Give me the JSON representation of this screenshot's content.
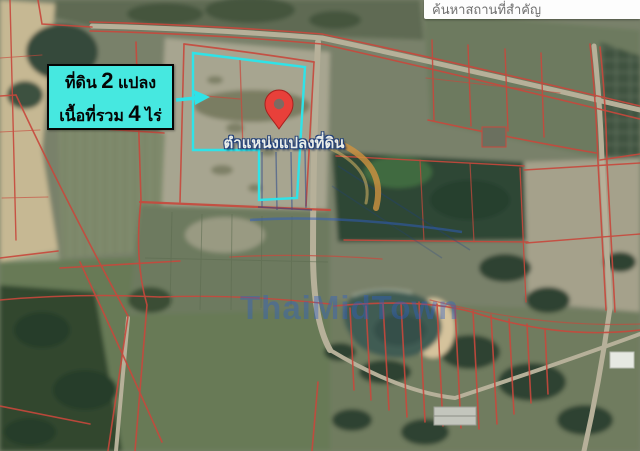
{
  "search_bar": {
    "placeholder": "ค้นหาสถานที่สำคัญ"
  },
  "callout": {
    "line1": {
      "prefix": "ที่ดิน",
      "number": "2",
      "suffix": "แปลง"
    },
    "line2": {
      "prefix": "เนื้อที่รวม",
      "number": "4",
      "suffix": "ไร่"
    }
  },
  "map": {
    "pin_caption": "ตำแหน่งแปลงที่ดิน",
    "watermark": "ThaiMidTown",
    "plots_outlined": 2,
    "area_rai": 4
  },
  "colors": {
    "callout_bg": "#46e8e0",
    "callout_border": "#050505",
    "plot_outline": "#2fe3e8",
    "arrow": "#2fe3e8",
    "pin_red": "#e8403a",
    "pin_inner": "#7d6a62",
    "parcel_line": "#c8483c",
    "survey_line": "#1d3f8c",
    "watermark_blue": "rgba(45,95,200,0.40)",
    "arc_orange": "#cf9240",
    "search_bg": "#ffffff",
    "search_text": "#707070"
  }
}
